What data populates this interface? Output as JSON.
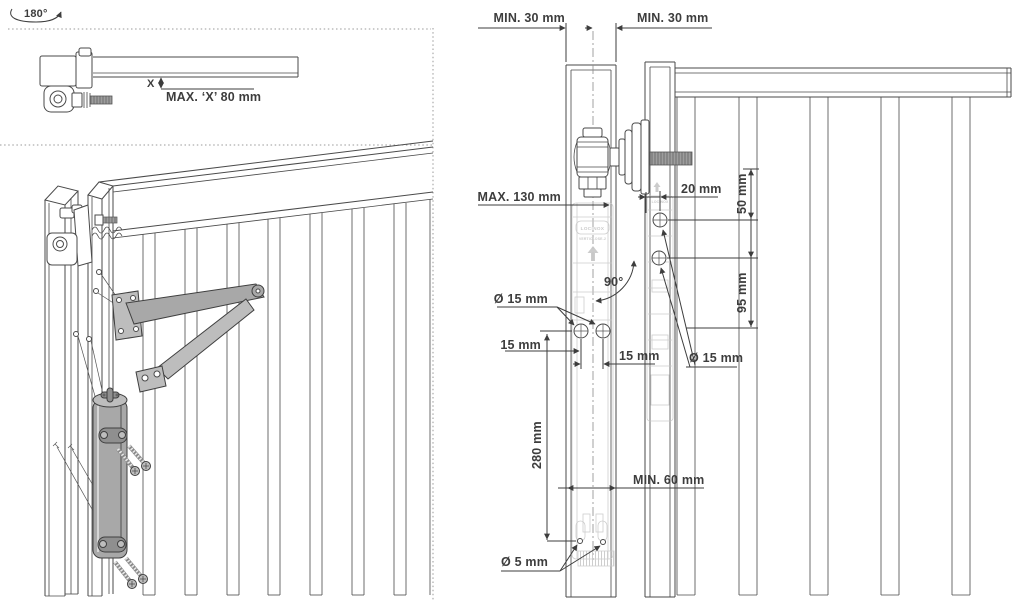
{
  "colors": {
    "background": "#ffffff",
    "line": "#4a4a4a",
    "dimension_text": "#3d3d3d",
    "metal_gray": "#a8a8a8",
    "faint_gray": "#c7c7c7"
  },
  "left_panel": {
    "rotation_label": "180°",
    "detail": {
      "x_marker": "X",
      "max_x_label": "MAX. ‘X’ 80 mm"
    }
  },
  "right_panel": {
    "dims": {
      "min_left": "MIN. 30 mm",
      "min_right": "MIN. 30 mm",
      "max_hinge": "MAX. 130 mm",
      "hole_offset": "20 mm",
      "top_hole": "50 mm",
      "angle": "90°",
      "post_hole_spacing": "95 mm",
      "dia_gate_holes": "Ø 15 mm",
      "edge_distance": "15 mm",
      "hole_pair_distance": "15 mm",
      "dia_post_holes": "Ø 15 mm",
      "body_length": "280 mm",
      "min_profile": "MIN. 60 mm",
      "dia_bottom_holes": "Ø 5 mm"
    },
    "branding": {
      "brand": "LOCINOX",
      "model": "VERTICLOSE-2",
      "brand_post": "LOCINOX"
    }
  }
}
